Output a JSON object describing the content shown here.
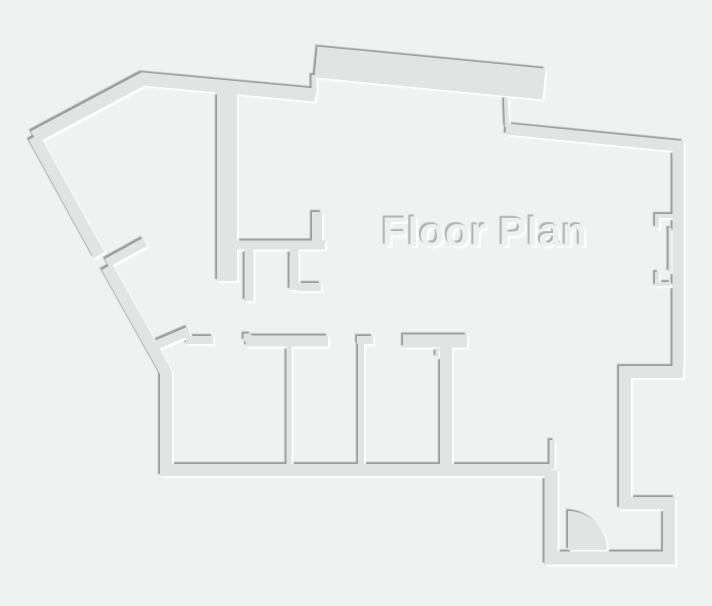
{
  "title": {
    "text": "Floor Plan"
  },
  "colors": {
    "background": "#f0f1f1",
    "wall_fill": "#e2e4e4",
    "shadow_dark": "#9b9d9d",
    "highlight": "#ffffff",
    "title_fill": "#eef0f0",
    "title_shadow_dark": "#b0b2b2"
  }
}
